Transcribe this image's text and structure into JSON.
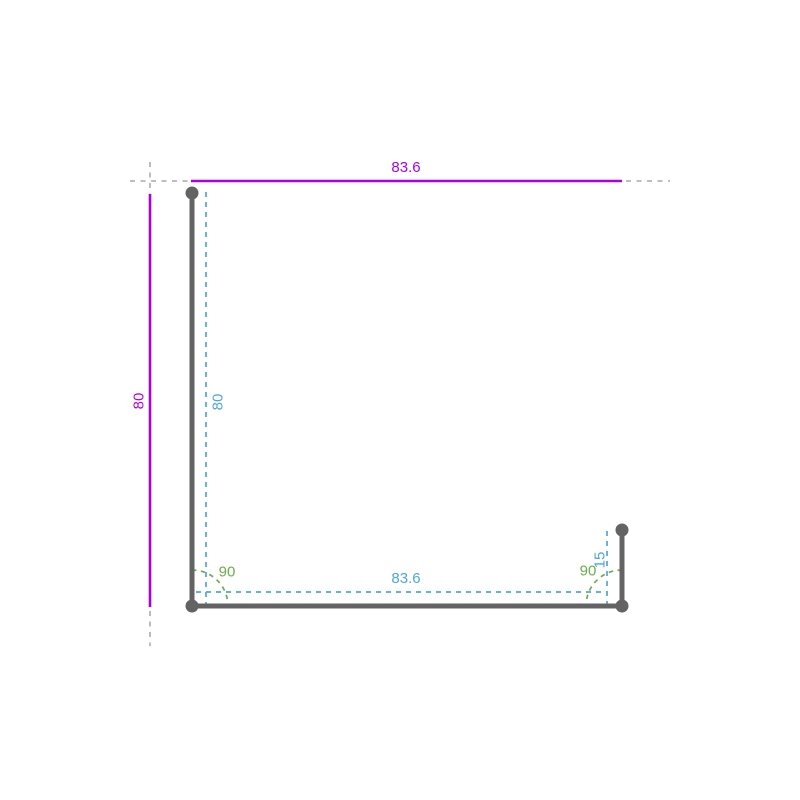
{
  "sketch": {
    "overall_width_label": "83.6",
    "overall_height_label": "80",
    "leg_height_label": "80",
    "bottom_width_label": "83.6",
    "lip_length_label": "15",
    "bottom_left_angle_label": "90",
    "bottom_right_angle_label": "90"
  },
  "colors": {
    "outer_dimension": "#aa00e6",
    "segment_dimension": "#4da7d5",
    "angle_dimension": "#69ae4b",
    "profile": "#636363",
    "extension": "#b5b5b5",
    "background": "#ffffff"
  }
}
